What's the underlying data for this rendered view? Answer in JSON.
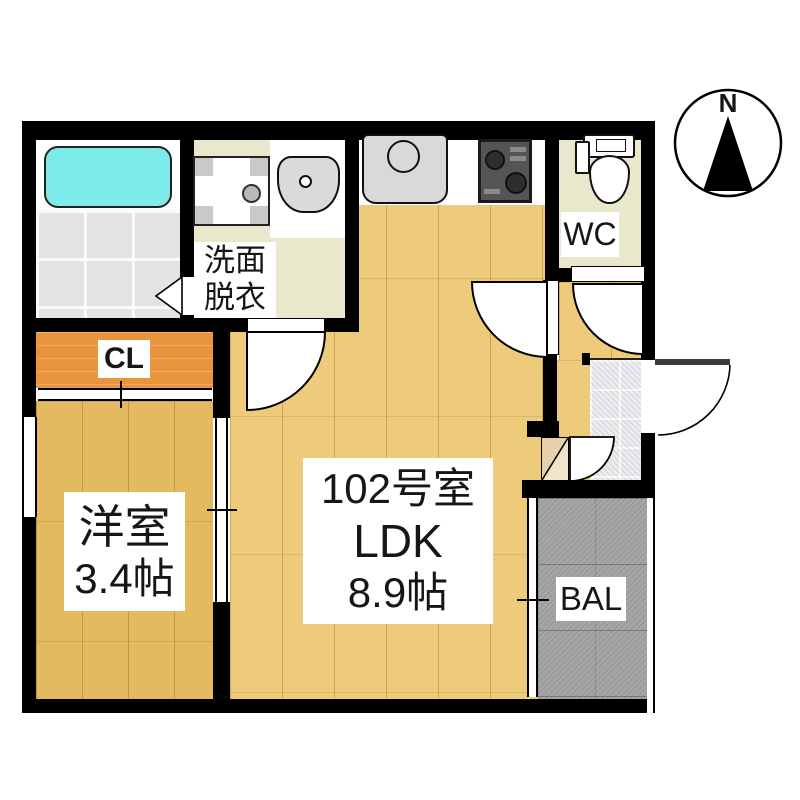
{
  "labels": {
    "unit_number": "102号室",
    "unit_type": "LDK",
    "unit_size": "8.9帖",
    "western_room_name": "洋室",
    "western_room_size": "3.4帖",
    "closet": "CL",
    "toilet": "WC",
    "balcony": "BAL",
    "washroom_line1": "洗面",
    "washroom_line2": "脱衣",
    "compass_north": "N"
  },
  "colors": {
    "bathtub": "#7debe9",
    "ldk_wood": "#eecb7b",
    "western_room_wood": "#e4ba60",
    "closet_floor": "#e9953e",
    "washroom_floor": "#eae8cc",
    "balcony_floor": "#a2a2a2",
    "wall": "#000000"
  }
}
